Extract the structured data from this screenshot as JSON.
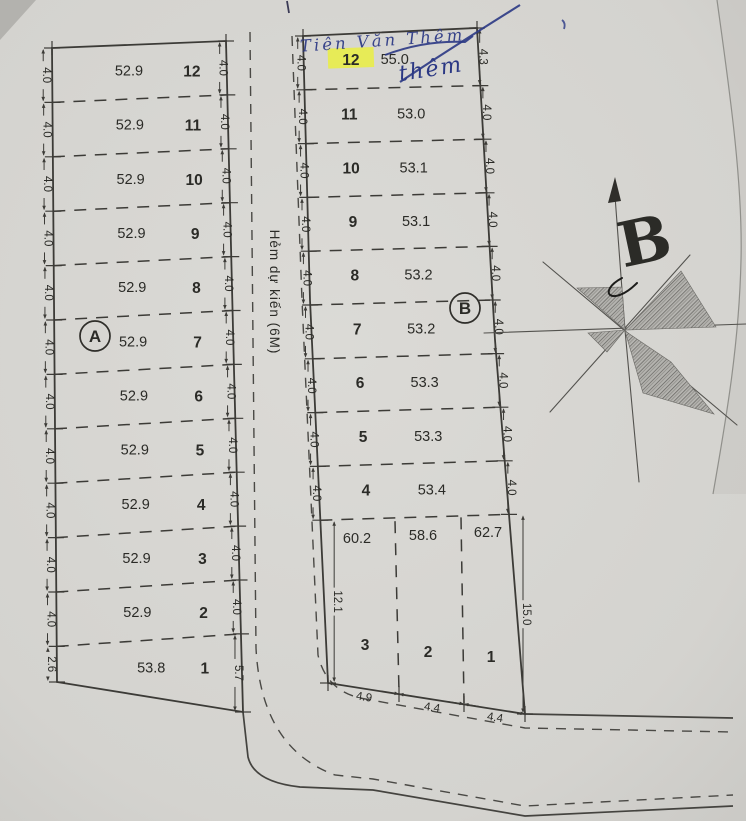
{
  "title": "Land plot survey sketch (scanned)",
  "handwriting": {
    "line1": "Tiên Văn Thêm",
    "line2": "thêm"
  },
  "north_letter": "B",
  "alley": {
    "label": "Hẻm dự kiến (6M)"
  },
  "block_a": {
    "label": "A",
    "plots": [
      {
        "no": "12",
        "area": "52.9"
      },
      {
        "no": "11",
        "area": "52.9"
      },
      {
        "no": "10",
        "area": "52.9"
      },
      {
        "no": "9",
        "area": "52.9"
      },
      {
        "no": "8",
        "area": "52.9"
      },
      {
        "no": "7",
        "area": "52.9"
      },
      {
        "no": "6",
        "area": "52.9"
      },
      {
        "no": "5",
        "area": "52.9"
      },
      {
        "no": "4",
        "area": "52.9"
      },
      {
        "no": "3",
        "area": "52.9"
      },
      {
        "no": "2",
        "area": "52.9"
      },
      {
        "no": "1",
        "area": "53.8"
      }
    ],
    "left_dims": [
      "4.0",
      "4.0",
      "4.0",
      "4.0",
      "4.0",
      "4.0",
      "4.0",
      "4.0",
      "4.0",
      "4.0",
      "4.0",
      "2.6"
    ],
    "right_dims": [
      "4.0",
      "4.0",
      "4.0",
      "4.0",
      "4.0",
      "4.0",
      "4.0",
      "4.0",
      "4.0",
      "4.0",
      "4.0",
      "5.7"
    ]
  },
  "block_b": {
    "label": "B",
    "plots": [
      {
        "no": "12",
        "area": "55.0",
        "highlighted": true
      },
      {
        "no": "11",
        "area": "53.0"
      },
      {
        "no": "10",
        "area": "53.1"
      },
      {
        "no": "9",
        "area": "53.1"
      },
      {
        "no": "8",
        "area": "53.2"
      },
      {
        "no": "7",
        "area": "53.2"
      },
      {
        "no": "6",
        "area": "53.3"
      },
      {
        "no": "5",
        "area": "53.3"
      },
      {
        "no": "4",
        "area": "53.4"
      }
    ],
    "bottom_plots": [
      {
        "no": "3",
        "area": "60.2"
      },
      {
        "no": "2",
        "area": "58.6"
      },
      {
        "no": "1",
        "area": "62.7"
      }
    ],
    "left_dims": [
      "4.0",
      "4.0",
      "4.0",
      "4.0",
      "4.0",
      "4.0",
      "4.0",
      "4.0",
      "4.0",
      "12.1"
    ],
    "right_dims": [
      "4.3",
      "4.0",
      "4.0",
      "4.0",
      "4.0",
      "4.0",
      "4.0",
      "4.0",
      "4.0",
      "15.0"
    ],
    "bottom_dims": [
      "4.9",
      "4.4",
      "4.4"
    ]
  },
  "colors": {
    "paper": "#d6d5d1",
    "ink": "#3c3b37",
    "pen_blue": "#2b3884",
    "highlight": "#e9ee45"
  }
}
